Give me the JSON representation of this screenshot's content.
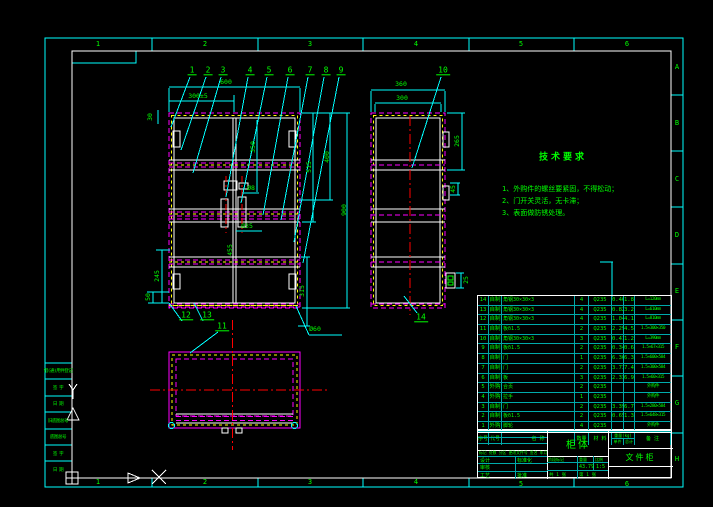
{
  "palette": {
    "frame_cyan": "#00ffff",
    "inner_frame_white": "#ffffff",
    "dash_magenta": "#ff00ff",
    "dash_yellow": "#ffff00",
    "center_red": "#ff0000",
    "text_green": "#00ff00",
    "background": "#000000"
  },
  "frame": {
    "zones_top": [
      {
        "t": "1",
        "x": 98,
        "y": 44
      },
      {
        "t": "2",
        "x": 205,
        "y": 44
      },
      {
        "t": "3",
        "x": 310,
        "y": 44
      },
      {
        "t": "4",
        "x": 416,
        "y": 44
      },
      {
        "t": "5",
        "x": 521,
        "y": 44
      },
      {
        "t": "6",
        "x": 627,
        "y": 44
      }
    ],
    "zones_bottom": [
      {
        "t": "1",
        "x": 98,
        "y": 482
      },
      {
        "t": "2",
        "x": 205,
        "y": 482
      },
      {
        "t": "3",
        "x": 310,
        "y": 482
      },
      {
        "t": "4",
        "x": 416,
        "y": 482
      },
      {
        "t": "5",
        "x": 521,
        "y": 484
      },
      {
        "t": "6",
        "x": 627,
        "y": 484
      }
    ],
    "zones_right": [
      {
        "t": "A",
        "x": 677,
        "y": 67
      },
      {
        "t": "B",
        "x": 677,
        "y": 123
      },
      {
        "t": "C",
        "x": 677,
        "y": 179
      },
      {
        "t": "D",
        "x": 677,
        "y": 235
      },
      {
        "t": "E",
        "x": 677,
        "y": 291
      },
      {
        "t": "F",
        "x": 677,
        "y": 347
      },
      {
        "t": "G",
        "x": 677,
        "y": 403
      },
      {
        "t": "H",
        "x": 677,
        "y": 459
      }
    ],
    "left_strip": [
      {
        "t": "借(通)用件登记",
        "x": 58,
        "y": 371
      },
      {
        "t": "签 字",
        "x": 58,
        "y": 388
      },
      {
        "t": "日 期",
        "x": 58,
        "y": 404
      },
      {
        "t": "旧底图总号",
        "x": 58,
        "y": 421
      },
      {
        "t": "底图总号",
        "x": 58,
        "y": 437
      },
      {
        "t": "签 字",
        "x": 58,
        "y": 454
      },
      {
        "t": "日 期",
        "x": 58,
        "y": 470
      }
    ]
  },
  "notes": {
    "title": "技术要求",
    "items": [
      {
        "t": "1、外购件的螺丝要紧固，不得松动；",
        "x": 502,
        "y": 184
      },
      {
        "t": "2、门开关灵活，无卡滞；",
        "x": 502,
        "y": 196
      },
      {
        "t": "3、表面做防锈处理。",
        "x": 502,
        "y": 208
      }
    ]
  },
  "balloons": [
    {
      "n": "1",
      "x": 192,
      "y": 71
    },
    {
      "n": "2",
      "x": 208,
      "y": 71
    },
    {
      "n": "3",
      "x": 223,
      "y": 71
    },
    {
      "n": "4",
      "x": 250,
      "y": 71
    },
    {
      "n": "5",
      "x": 269,
      "y": 71
    },
    {
      "n": "6",
      "x": 290,
      "y": 71
    },
    {
      "n": "7",
      "x": 310,
      "y": 71
    },
    {
      "n": "8",
      "x": 326,
      "y": 71
    },
    {
      "n": "9",
      "x": 341,
      "y": 71
    },
    {
      "n": "10",
      "x": 443,
      "y": 71
    },
    {
      "n": "11",
      "x": 222,
      "y": 327
    },
    {
      "n": "12",
      "x": 186,
      "y": 316
    },
    {
      "n": "13",
      "x": 207,
      "y": 316
    },
    {
      "n": "14",
      "x": 421,
      "y": 318
    }
  ],
  "dims": [
    {
      "t": "600",
      "x": 226,
      "y": 82
    },
    {
      "t": "300±5",
      "x": 198,
      "y": 96
    },
    {
      "t": "30",
      "x": 150,
      "y": 117,
      "r": -90
    },
    {
      "t": "350",
      "x": 253,
      "y": 147,
      "r": -90
    },
    {
      "t": "455",
      "x": 230,
      "y": 250,
      "r": -90
    },
    {
      "t": "515",
      "x": 309,
      "y": 167,
      "r": -90
    },
    {
      "t": "400",
      "x": 327,
      "y": 157,
      "r": -90
    },
    {
      "t": "900",
      "x": 344,
      "y": 210,
      "r": -90
    },
    {
      "t": "245",
      "x": 157,
      "y": 276,
      "r": -90
    },
    {
      "t": "50",
      "x": 148,
      "y": 297,
      "r": -90
    },
    {
      "t": "315",
      "x": 302,
      "y": 291,
      "r": -90
    },
    {
      "t": "Ø35",
      "x": 247,
      "y": 226
    },
    {
      "t": "Ø8",
      "x": 251,
      "y": 188
    },
    {
      "t": "Ø60",
      "x": 315,
      "y": 329
    },
    {
      "t": "360",
      "x": 401,
      "y": 84
    },
    {
      "t": "300",
      "x": 402,
      "y": 98
    },
    {
      "t": "265",
      "x": 457,
      "y": 141,
      "r": -90
    },
    {
      "t": "45",
      "x": 453,
      "y": 189,
      "r": -90
    },
    {
      "t": "25",
      "x": 466,
      "y": 280,
      "r": -90
    }
  ],
  "bom": {
    "headers": {
      "no": "序号",
      "code": "代号",
      "name": "名  称",
      "qty": "数量",
      "mat": "材 料",
      "wt": "重量(kg)",
      "unit": "单件",
      "total": "总计",
      "remark": "备 注"
    },
    "rows": [
      {
        "no": "14",
        "code": "自制",
        "name": "角钢30×30×3",
        "qty": "4",
        "mat": "Q235",
        "unit": "0.46",
        "total": "1.82",
        "remark": "L=120mm"
      },
      {
        "no": "13",
        "code": "自制",
        "name": "角钢30×30×3",
        "qty": "4",
        "mat": "Q235",
        "unit": "0.82",
        "total": "3.28",
        "remark": "L=610mm"
      },
      {
        "no": "12",
        "code": "自制",
        "name": "角钢30×30×3",
        "qty": "4",
        "mat": "Q235",
        "unit": "1.04",
        "total": "4.16",
        "remark": "L=810mm"
      },
      {
        "no": "11",
        "code": "自制",
        "name": "板δ1.5",
        "qty": "2",
        "mat": "Q235",
        "unit": "2.29",
        "total": "4.58",
        "remark": "1.5×300×350"
      },
      {
        "no": "10",
        "code": "自制",
        "name": "角钢30×30×3",
        "qty": "3",
        "mat": "Q235",
        "unit": "0.41",
        "total": "1.23",
        "remark": "L=390mm"
      },
      {
        "no": "9",
        "code": "自制",
        "name": "板δ1.5",
        "qty": "2",
        "mat": "Q235",
        "unit": "0.34",
        "total": "0.68",
        "remark": "1.5×67×315"
      },
      {
        "no": "8",
        "code": "自制",
        "name": "门",
        "qty": "1",
        "mat": "Q235",
        "unit": "6.36",
        "total": "6.36",
        "remark": "1.5×600×584"
      },
      {
        "no": "7",
        "code": "自制",
        "name": "门",
        "qty": "2",
        "mat": "Q235",
        "unit": "3.73",
        "total": "7.46",
        "remark": "1.5×300×584"
      },
      {
        "no": "6",
        "code": "自制",
        "name": "板",
        "qty": "3",
        "mat": "Q235",
        "unit": "2.33",
        "total": "6.99",
        "remark": "1.5×60×315"
      },
      {
        "no": "5",
        "code": "外购",
        "name": "合页",
        "qty": "2",
        "mat": "Q235",
        "unit": "",
        "total": "",
        "remark": "外购件"
      },
      {
        "no": "4",
        "code": "外购",
        "name": "拉手",
        "qty": "1",
        "mat": "Q235",
        "unit": "",
        "total": "",
        "remark": "外购件"
      },
      {
        "no": "3",
        "code": "自制",
        "name": "门",
        "qty": "2",
        "mat": "Q235",
        "unit": "3.39",
        "total": "6.78",
        "remark": "1.5×280×584"
      },
      {
        "no": "2",
        "code": "自制",
        "name": "板δ1.5",
        "qty": "2",
        "mat": "Q235",
        "unit": "0.65",
        "total": "1.30",
        "remark": "1.5×648×315"
      },
      {
        "no": "1",
        "code": "外购",
        "name": "脚轮",
        "qty": "4",
        "mat": "Q235",
        "unit": "",
        "total": "",
        "remark": "外购件"
      }
    ]
  },
  "titleblock": {
    "mark_row": "标记 处数 分区 更改文件号 签名 年月日",
    "design": "设计",
    "standard": "标准化",
    "check": "审核",
    "process": "工艺",
    "approve": "批准",
    "stage_label": "阶段标记",
    "weight_label": "重量",
    "scale_label": "比例",
    "weight": "43.79",
    "scale": "1:5",
    "sheet_total": "共 1 张",
    "sheet_no": "第 1 张",
    "part_name": "柜体",
    "product_name": "文件柜"
  }
}
